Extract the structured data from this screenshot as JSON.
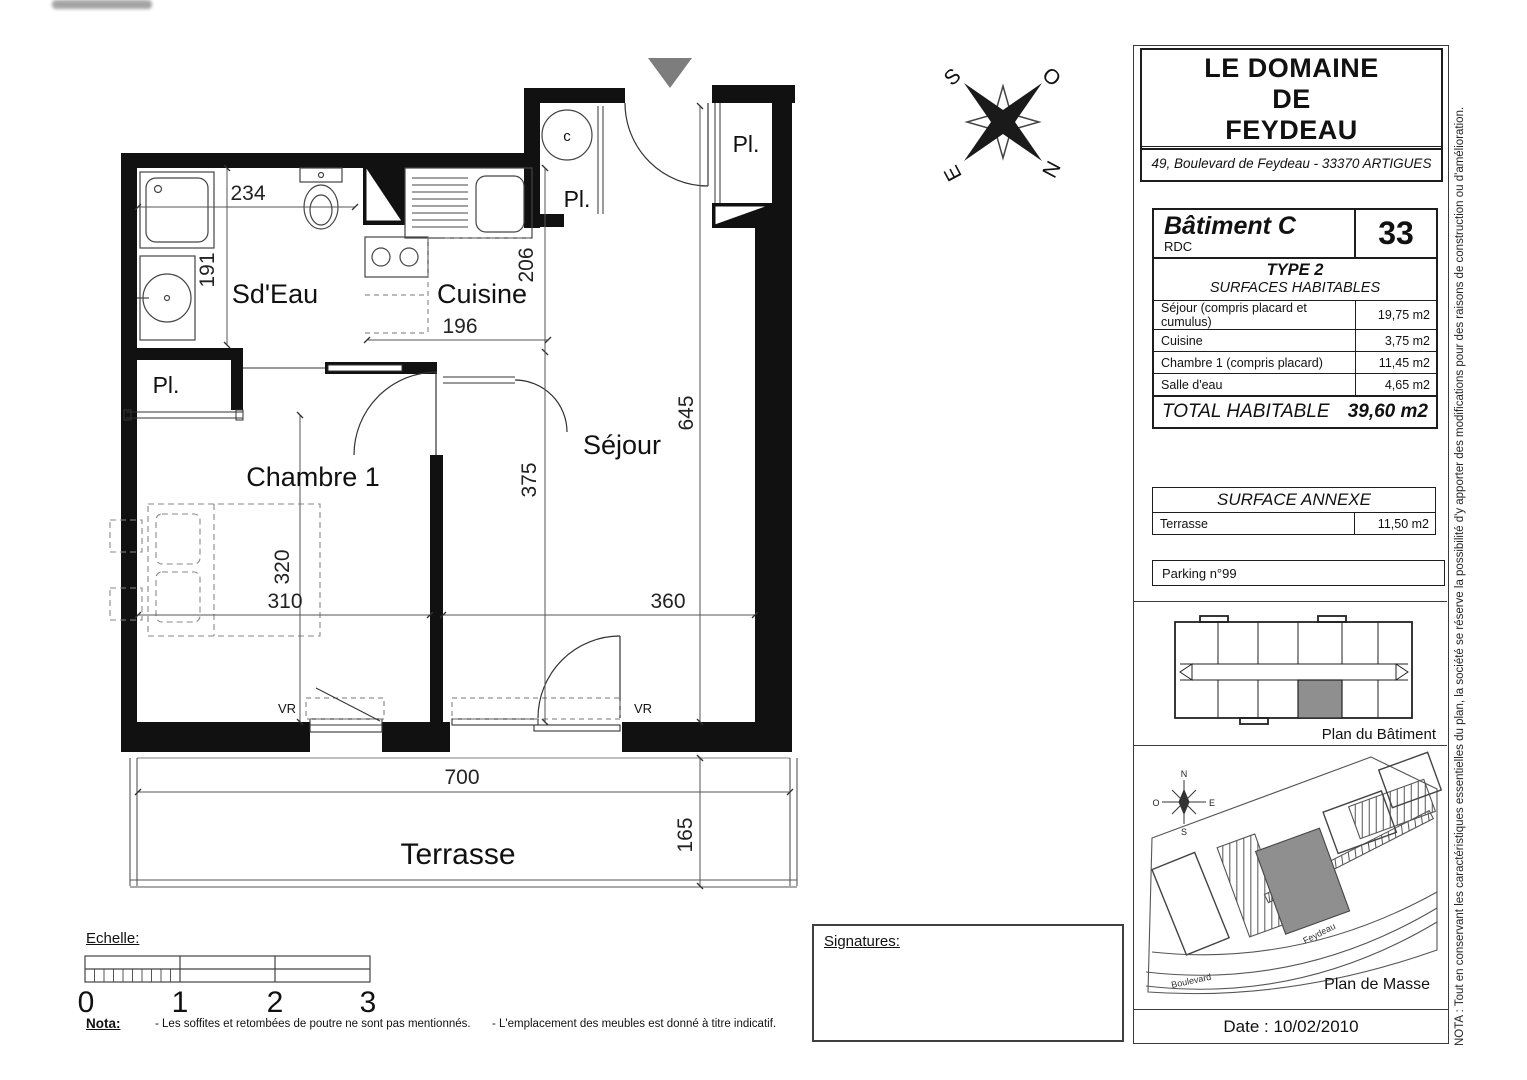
{
  "floor_plan": {
    "rooms": {
      "sdeau": "Sd'Eau",
      "cuisine": "Cuisine",
      "chambre": "Chambre 1",
      "sejour": "Séjour",
      "terrasse": "Terrasse"
    },
    "closets": {
      "left": "Pl.",
      "hall": "Pl.",
      "entry": "Pl."
    },
    "cumulus": "c",
    "vr": "VR",
    "dims": {
      "sdeau_w": "234",
      "sdeau_h": "191",
      "cuisine_h": "206",
      "cuisine_w": "196",
      "sejour_len": "645",
      "sejour_h": "375",
      "chambre_h": "320",
      "chambre_w": "310",
      "sejour_w": "360",
      "terrasse_w": "700",
      "terrasse_d": "165"
    }
  },
  "compass": {
    "s": "S",
    "o": "O",
    "e": "E",
    "n": "N"
  },
  "title_block": {
    "title_line1": "LE DOMAINE",
    "title_line2": "DE",
    "title_line3": "FEYDEAU",
    "address": "49, Boulevard de Feydeau - 33370 ARTIGUES",
    "building": {
      "name": "Bâtiment C",
      "floor": "RDC",
      "lot_number": "33"
    },
    "type_label": "TYPE 2",
    "surfaces_header": "SURFACES HABITABLES",
    "surface_rows": [
      {
        "label": "Séjour (compris placard et cumulus)",
        "value": "19,75 m2"
      },
      {
        "label": "Cuisine",
        "value": "3,75 m2"
      },
      {
        "label": "Chambre 1 (compris placard)",
        "value": "11,45 m2"
      },
      {
        "label": "Salle d'eau",
        "value": "4,65 m2"
      }
    ],
    "total": {
      "label": "TOTAL HABITABLE",
      "value": "39,60 m2"
    },
    "annexe": {
      "header": "SURFACE ANNEXE",
      "row": {
        "label": "Terrasse",
        "value": "11,50 m2"
      }
    },
    "parking": "Parking n°99",
    "plan_batiment_caption": "Plan du Bâtiment",
    "plan_masse_caption": "Plan de Masse",
    "masse_street_1": "Boulevard",
    "masse_street_2": "Feydeau",
    "masse_compass": {
      "n": "N",
      "s": "S",
      "o": "O",
      "e": "E"
    },
    "date": "Date : 10/02/2010"
  },
  "footer": {
    "echelle_label": "Echelle:",
    "scale_numbers": [
      "0",
      "1",
      "2",
      "3"
    ],
    "nota_label": "Nota:",
    "nota_item_1": "- Les soffites et retombées de poutre ne sont pas mentionnés.",
    "nota_item_2": "- L'emplacement des meubles est donné à titre indicatif.",
    "signatures_label": "Signatures:"
  },
  "side_note": "NOTA : Tout en conservant les caractéristiques essentielles du plan, la société se réserve la possibilité d'y apporter des modifications pour des raisons de construction ou d'amélioration.",
  "colors": {
    "wall": "#111111",
    "line": "#333333",
    "dim": "#555555",
    "shaded_unit": "#8f8f8f",
    "entrance_marker": "#7d7d7d"
  }
}
